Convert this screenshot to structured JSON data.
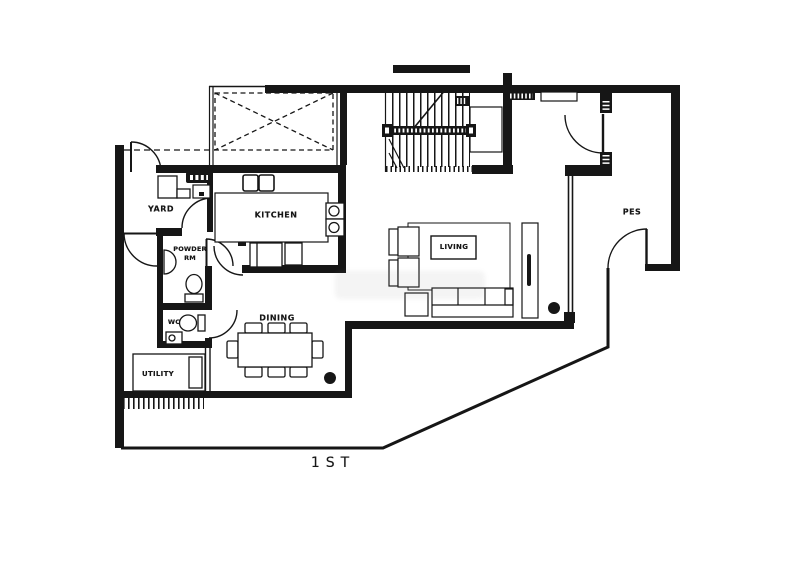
{
  "meta": {
    "type": "architectural-floor-plan",
    "floor_label": "1ST"
  },
  "rooms": {
    "yard": "YARD",
    "kitchen": "KITCHEN",
    "powder_line1": "POWDER",
    "powder_line2": "RM",
    "wc": "WC",
    "utility": "UTILITY",
    "dining": "DINING",
    "living": "LIVING",
    "pes": "PES"
  },
  "colors": {
    "ink": "#161616",
    "paper": "#ffffff"
  }
}
